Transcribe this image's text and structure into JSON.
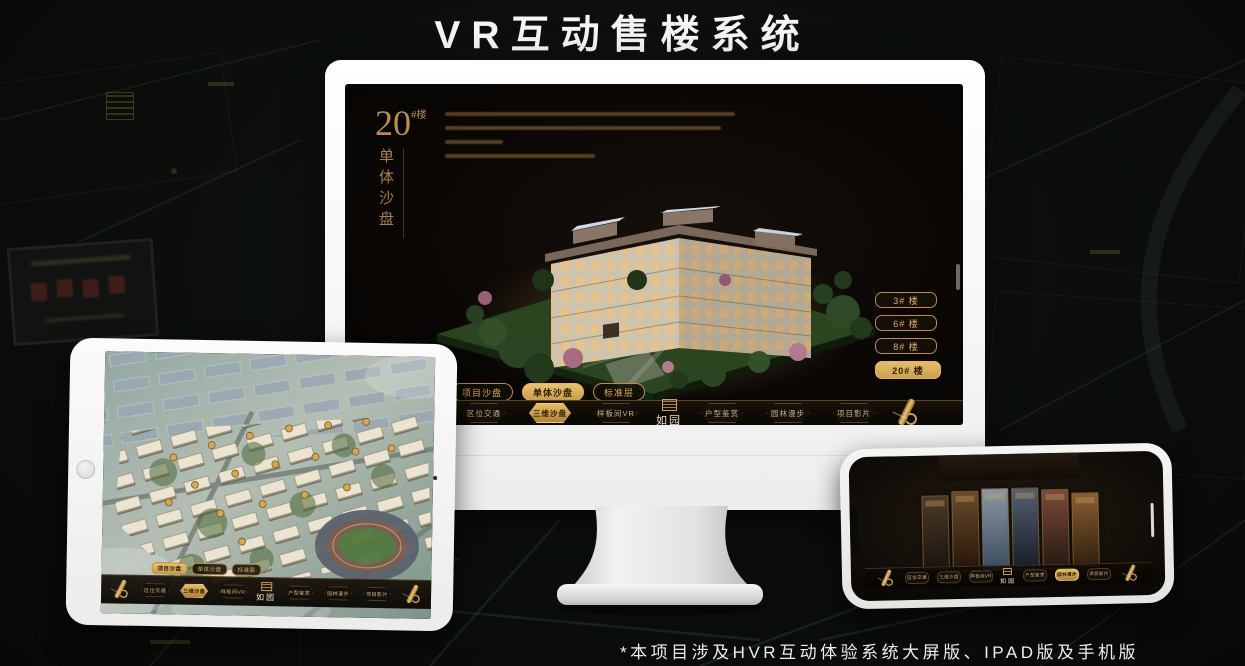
{
  "header": {
    "title": "VR互动售楼系统"
  },
  "footer": {
    "note": "*本项目涉及HVR互动体验系统大屏版、IPAD版及手机版"
  },
  "brand": {
    "logo_text": "如园"
  },
  "colors": {
    "gold": "#c9a254",
    "gold_bright": "#e7bc64",
    "screen_bg": "#0a0705",
    "title_white": "#f5f5f5"
  },
  "monitor": {
    "unit_title": {
      "number": "20",
      "suffix": "#楼",
      "subtitle": "单体沙盘"
    },
    "floor_buttons": [
      {
        "label": "3# 楼",
        "active": false
      },
      {
        "label": "6# 楼",
        "active": false
      },
      {
        "label": "8# 楼",
        "active": false
      },
      {
        "label": "20# 楼",
        "active": true
      }
    ],
    "view_tabs": [
      {
        "label": "项目沙盘",
        "active": false
      },
      {
        "label": "单体沙盘",
        "active": true
      },
      {
        "label": "标准层",
        "active": false
      }
    ],
    "nav_left": [
      {
        "label": "区位交通",
        "active": false
      },
      {
        "label": "三维沙盘",
        "active": true
      },
      {
        "label": "样板间VR",
        "active": false
      }
    ],
    "nav_right": [
      {
        "label": "户型鉴赏",
        "active": false
      },
      {
        "label": "园林漫步",
        "active": false
      },
      {
        "label": "项目影片",
        "active": false
      }
    ]
  },
  "tablet": {
    "view_tabs": [
      {
        "label": "项目沙盘",
        "active": true
      },
      {
        "label": "单体沙盘",
        "active": false
      },
      {
        "label": "标准层",
        "active": false
      }
    ],
    "nav_left": [
      {
        "label": "区位交通",
        "active": false
      },
      {
        "label": "三维沙盘",
        "active": true
      },
      {
        "label": "样板间VR",
        "active": false
      }
    ],
    "nav_right": [
      {
        "label": "户型鉴赏",
        "active": false
      },
      {
        "label": "园林漫步",
        "active": false
      },
      {
        "label": "项目影片",
        "active": false
      }
    ]
  },
  "phone": {
    "nav_left": [
      {
        "label": "区位交通",
        "active": false
      },
      {
        "label": "三维沙盘",
        "active": false
      },
      {
        "label": "样板间VR",
        "active": false
      }
    ],
    "nav_right": [
      {
        "label": "户型鉴赏",
        "active": false
      },
      {
        "label": "园林漫步",
        "active": true
      },
      {
        "label": "项目影片",
        "active": false
      }
    ]
  }
}
